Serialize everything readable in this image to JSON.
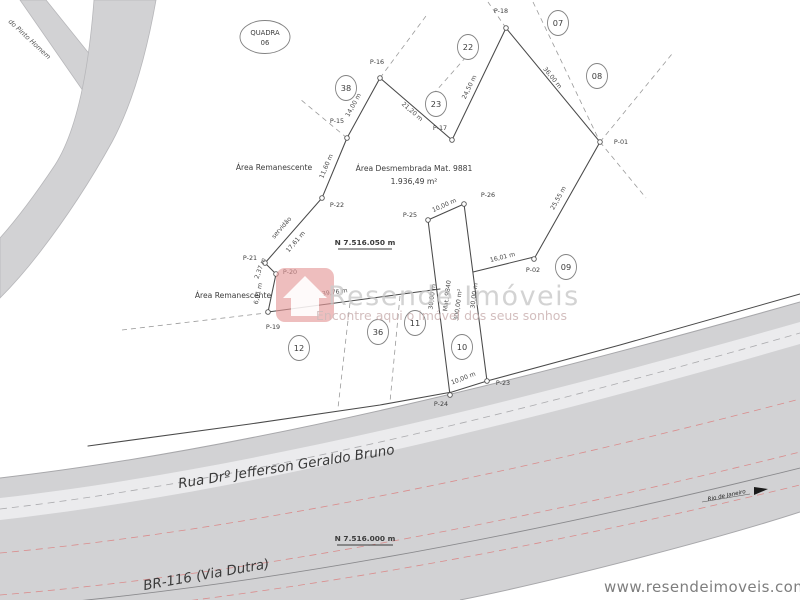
{
  "colors": {
    "road_gray": "#d2d2d4",
    "parcel_line": "#4a4a4a",
    "dashed_line": "#9a9a9a",
    "red_center_line": "#da8c8c",
    "watermark_pink": "#e59898",
    "watermark_text": "#c6c6c6"
  },
  "quadra": {
    "label": "QUADRA",
    "number": "06"
  },
  "streets": {
    "top_left": "do Pinto Homem",
    "main": "Rua Drº Jefferson Geraldo Bruno",
    "highway": "BR-116 (Via Dutra)",
    "direction": "Rio de Janeiro"
  },
  "coordinates": {
    "north_upper": "N 7.516.050 m",
    "north_lower": "N 7.516.000 m"
  },
  "areas": {
    "remanescente_upper": "Área Remanescente",
    "remanescente_lower": "Área Remanescente",
    "desmembrada_title": "Área Desmembrada Mat. 9881",
    "desmembrada_value": "1.936,49 m²",
    "lot10_mat": "Mat. 9840",
    "lot10_area": "300,00 m²",
    "servidao": "servidão"
  },
  "lots": {
    "n07": "07",
    "n08": "08",
    "n09": "09",
    "n10": "10",
    "n11": "11",
    "n12": "12",
    "n22": "22",
    "n23": "23",
    "n36": "36",
    "n38": "38"
  },
  "points": {
    "p01": "P-01",
    "p02": "P-02",
    "p15": "P-15",
    "p16": "P-16",
    "p17": "P-17",
    "p18": "P-18",
    "p19": "P-19",
    "p20": "P-20",
    "p21": "P-21",
    "p22": "P-22",
    "p23": "P-23",
    "p24": "P-24",
    "p25": "P-25",
    "p26": "P-26"
  },
  "measurements": {
    "seg_16_15": "14,00 m",
    "seg_16_17": "21,20 m",
    "seg_17_18": "24,50 m",
    "seg_18_01": "36,00 m",
    "seg_01_02": "25,55 m",
    "seg_26_02": "16,01 m",
    "seg_19_25": "39,76 m",
    "seg_15_22": "11,60 m",
    "seg_22_21": "17,61 m",
    "seg_21_20": "2,37 m",
    "seg_20_19": "6,01 m",
    "strip_top": "10,00 m",
    "strip_bottom": "10,00 m",
    "strip_left": "30,00 m",
    "strip_right": "30,00 m"
  },
  "watermark": {
    "brand": "Resende Imóveis",
    "tagline": "Encontre aqui o imóvel dos seus sonhos"
  },
  "footer": {
    "website": "www.resendeimoveis.com.br"
  }
}
